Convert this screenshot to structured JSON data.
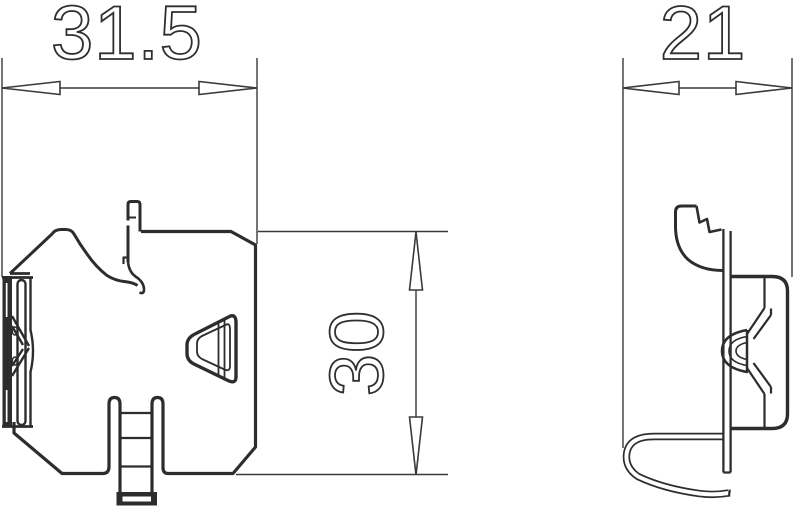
{
  "drawing": {
    "type": "technical-dimension-drawing",
    "views": {
      "front": "front-view",
      "side": "side-view"
    },
    "dimensions": {
      "front_width": {
        "value": "31.5"
      },
      "side_width": {
        "value": "21"
      },
      "height": {
        "value": "30"
      }
    },
    "colors": {
      "line": "#2d2d2d",
      "background": "#ffffff"
    }
  }
}
